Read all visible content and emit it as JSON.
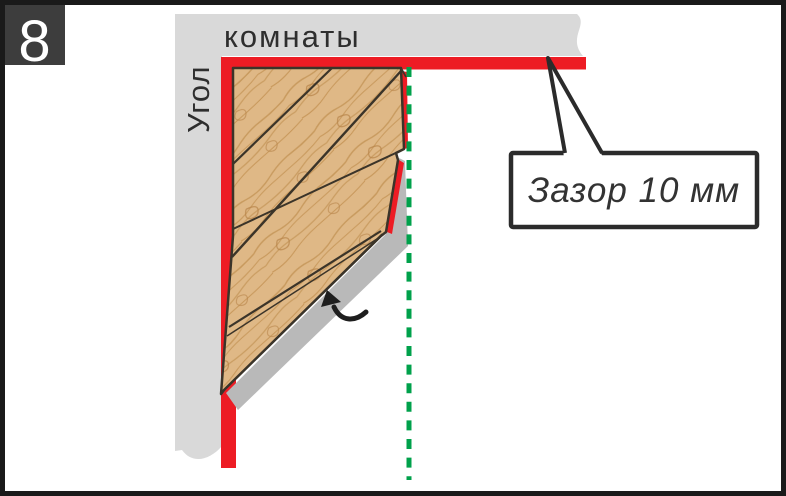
{
  "step": {
    "number": "8"
  },
  "diagram": {
    "wall_label_top": "комнаты",
    "wall_label_left": "Угол",
    "callout_text": "Зазор 10 мм"
  },
  "colors": {
    "frame": "#1a1a1a",
    "badge_bg": "#3d3d3d",
    "badge_text": "#ffffff",
    "wall_gray": "#d9d9d9",
    "gap_red": "#ed1c24",
    "wood": "#dfb886",
    "wood_grain": "#c2914f",
    "plank_outline": "#3b3429",
    "shadow_gray": "#b9b9b9",
    "guide_green": "#00a14b",
    "callout_border": "#2b2b2b",
    "label_text": "#2e2e2e"
  }
}
